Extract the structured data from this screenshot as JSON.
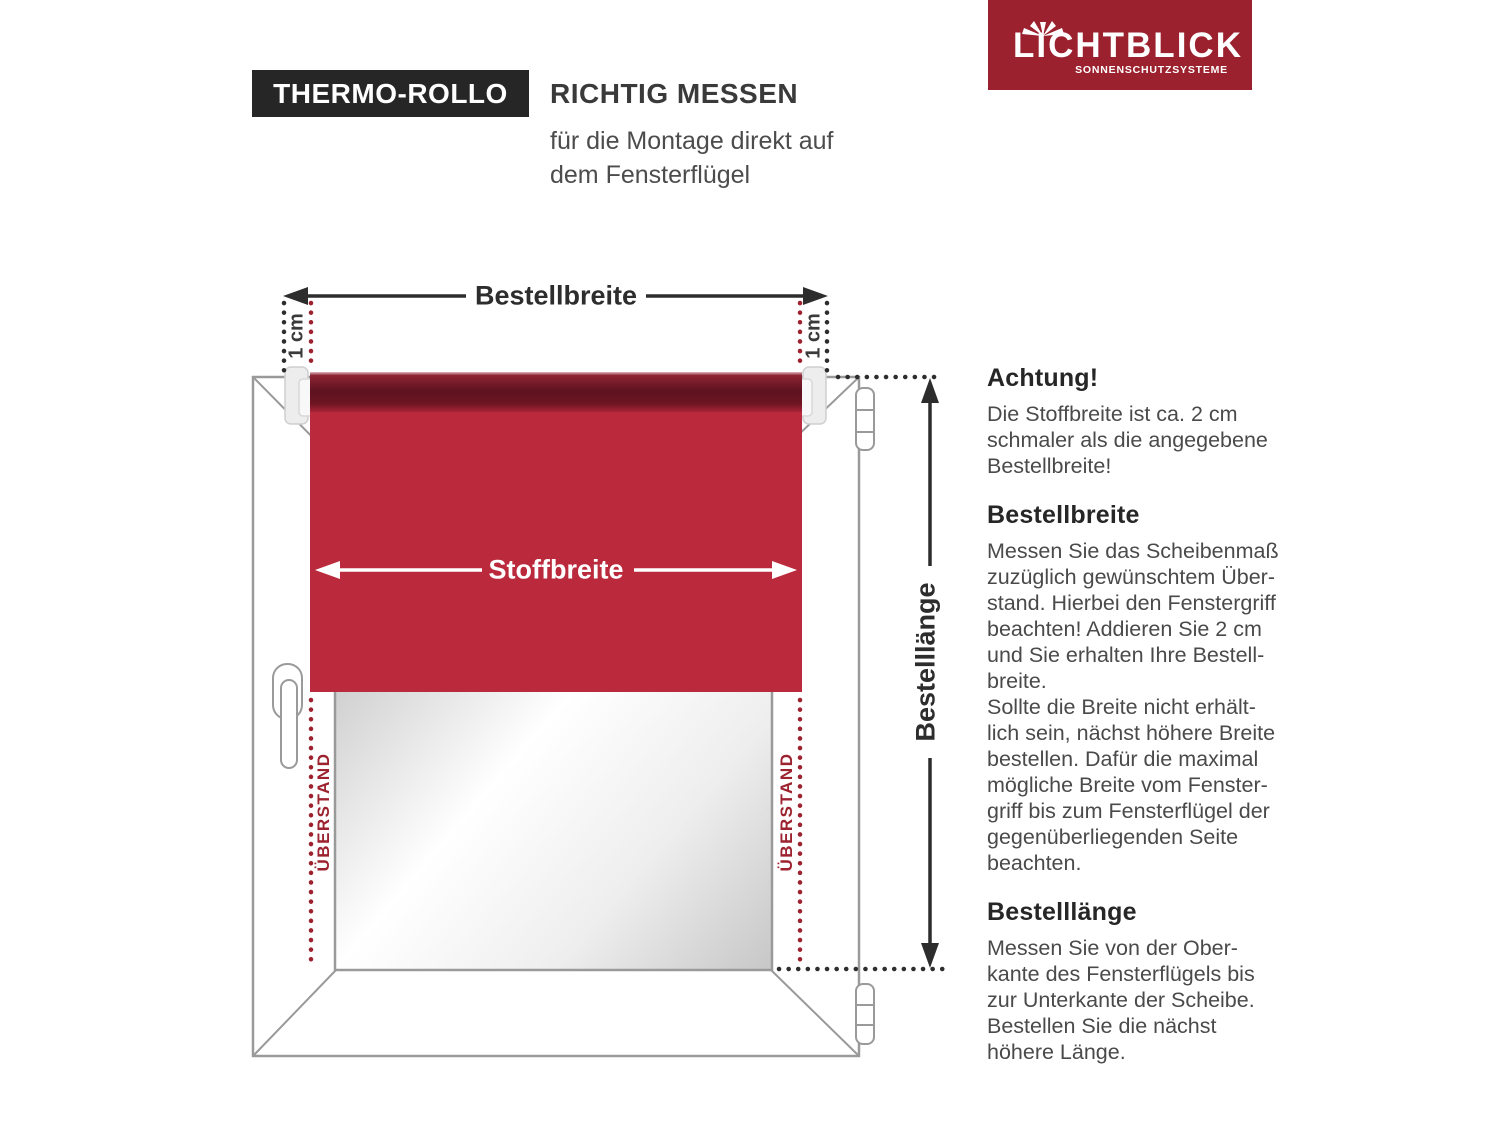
{
  "header": {
    "badge": "THERMO-ROLLO",
    "title": "RICHTIG MESSEN",
    "subtitle": "für die Montage direkt auf\ndem Fensterflügel"
  },
  "logo": {
    "brand": "LICHTBLICK",
    "tagline": "SONNENSCHUTZSYSTEME",
    "bg_color": "#9b212e",
    "icon": "sunburst-icon"
  },
  "diagram": {
    "order_width_label": "Bestellbreite",
    "fabric_width_label": "Stoffbreite",
    "order_length_label": "Bestelllänge",
    "overhang_label_left": "ÜBERSTAND",
    "overhang_label_right": "ÜBERSTAND",
    "margin_label_left": "1 cm",
    "margin_label_right": "1 cm",
    "colors": {
      "fabric_red": "#bb2a3c",
      "accent_red": "#9b222e",
      "frame_gray": "#9a9a9a",
      "ink": "#2d2d2d"
    }
  },
  "info": {
    "sections": [
      {
        "heading": "Achtung!",
        "body": "Die Stoffbreite ist ca. 2 cm\nschmaler als die angegebene\nBestellbreite!"
      },
      {
        "heading": "Bestellbreite",
        "body": "Messen Sie das Scheibenmaß\nzuzüglich gewünschtem Über-\nstand. Hierbei den Fenstergriff\nbeachten! Addieren Sie 2 cm\nund Sie erhalten Ihre Bestell-\nbreite.\nSollte die Breite nicht erhält-\nlich sein, nächst höhere Breite\nbestellen. Dafür die maximal\nmögliche Breite vom Fenster-\ngriff bis zum Fensterflügel der\ngegenüberliegenden Seite\nbeachten."
      },
      {
        "heading": "Bestelllänge",
        "body": "Messen Sie von der Ober-\nkante des Fensterflügels bis\nzur Unterkante der Scheibe.\nBestellen Sie die nächst\nhöhere Länge."
      }
    ]
  }
}
